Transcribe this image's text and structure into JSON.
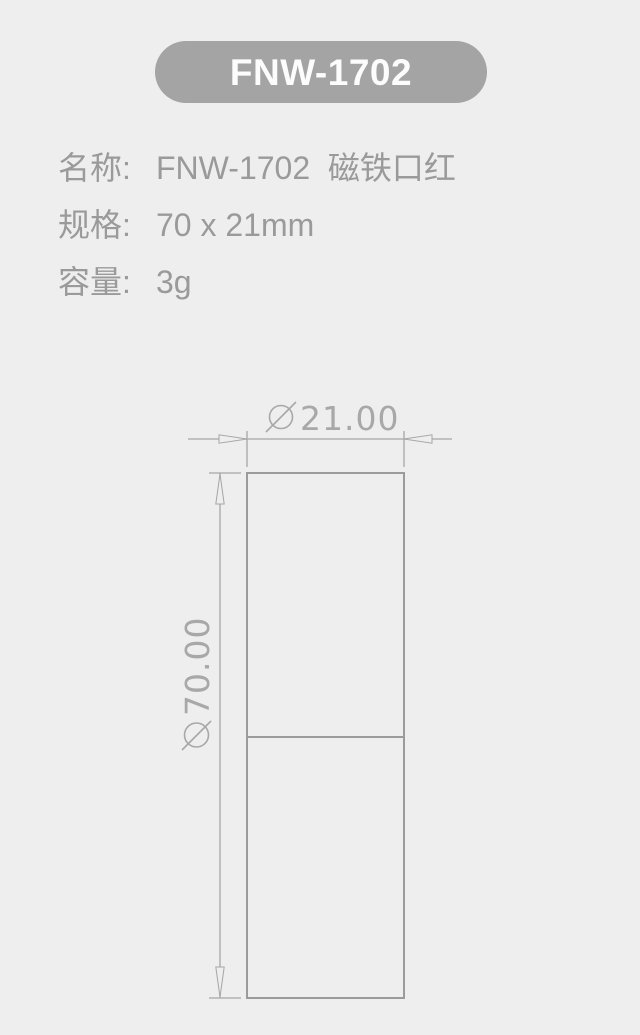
{
  "badge": {
    "label": "FNW-1702",
    "bg_color": "#a4a4a4",
    "text_color": "#fcfcfc"
  },
  "specs": [
    {
      "label": "名称:",
      "value": "FNW-1702  磁铁口红"
    },
    {
      "label": "规格:",
      "value": "70 x 21mm"
    },
    {
      "label": "容量:",
      "value": "3g"
    }
  ],
  "drawing": {
    "type": "dimensioned outline drawing of lipstick tube, front view",
    "width_dimension": {
      "symbol": "⌀",
      "value": "21.00"
    },
    "height_dimension": {
      "symbol": "⌀",
      "value": "70.00"
    },
    "line_color": "#a6a6a6",
    "outline_color": "#9b9b9b",
    "text_color": "#a8a8a8",
    "background": "#eeeeee"
  }
}
